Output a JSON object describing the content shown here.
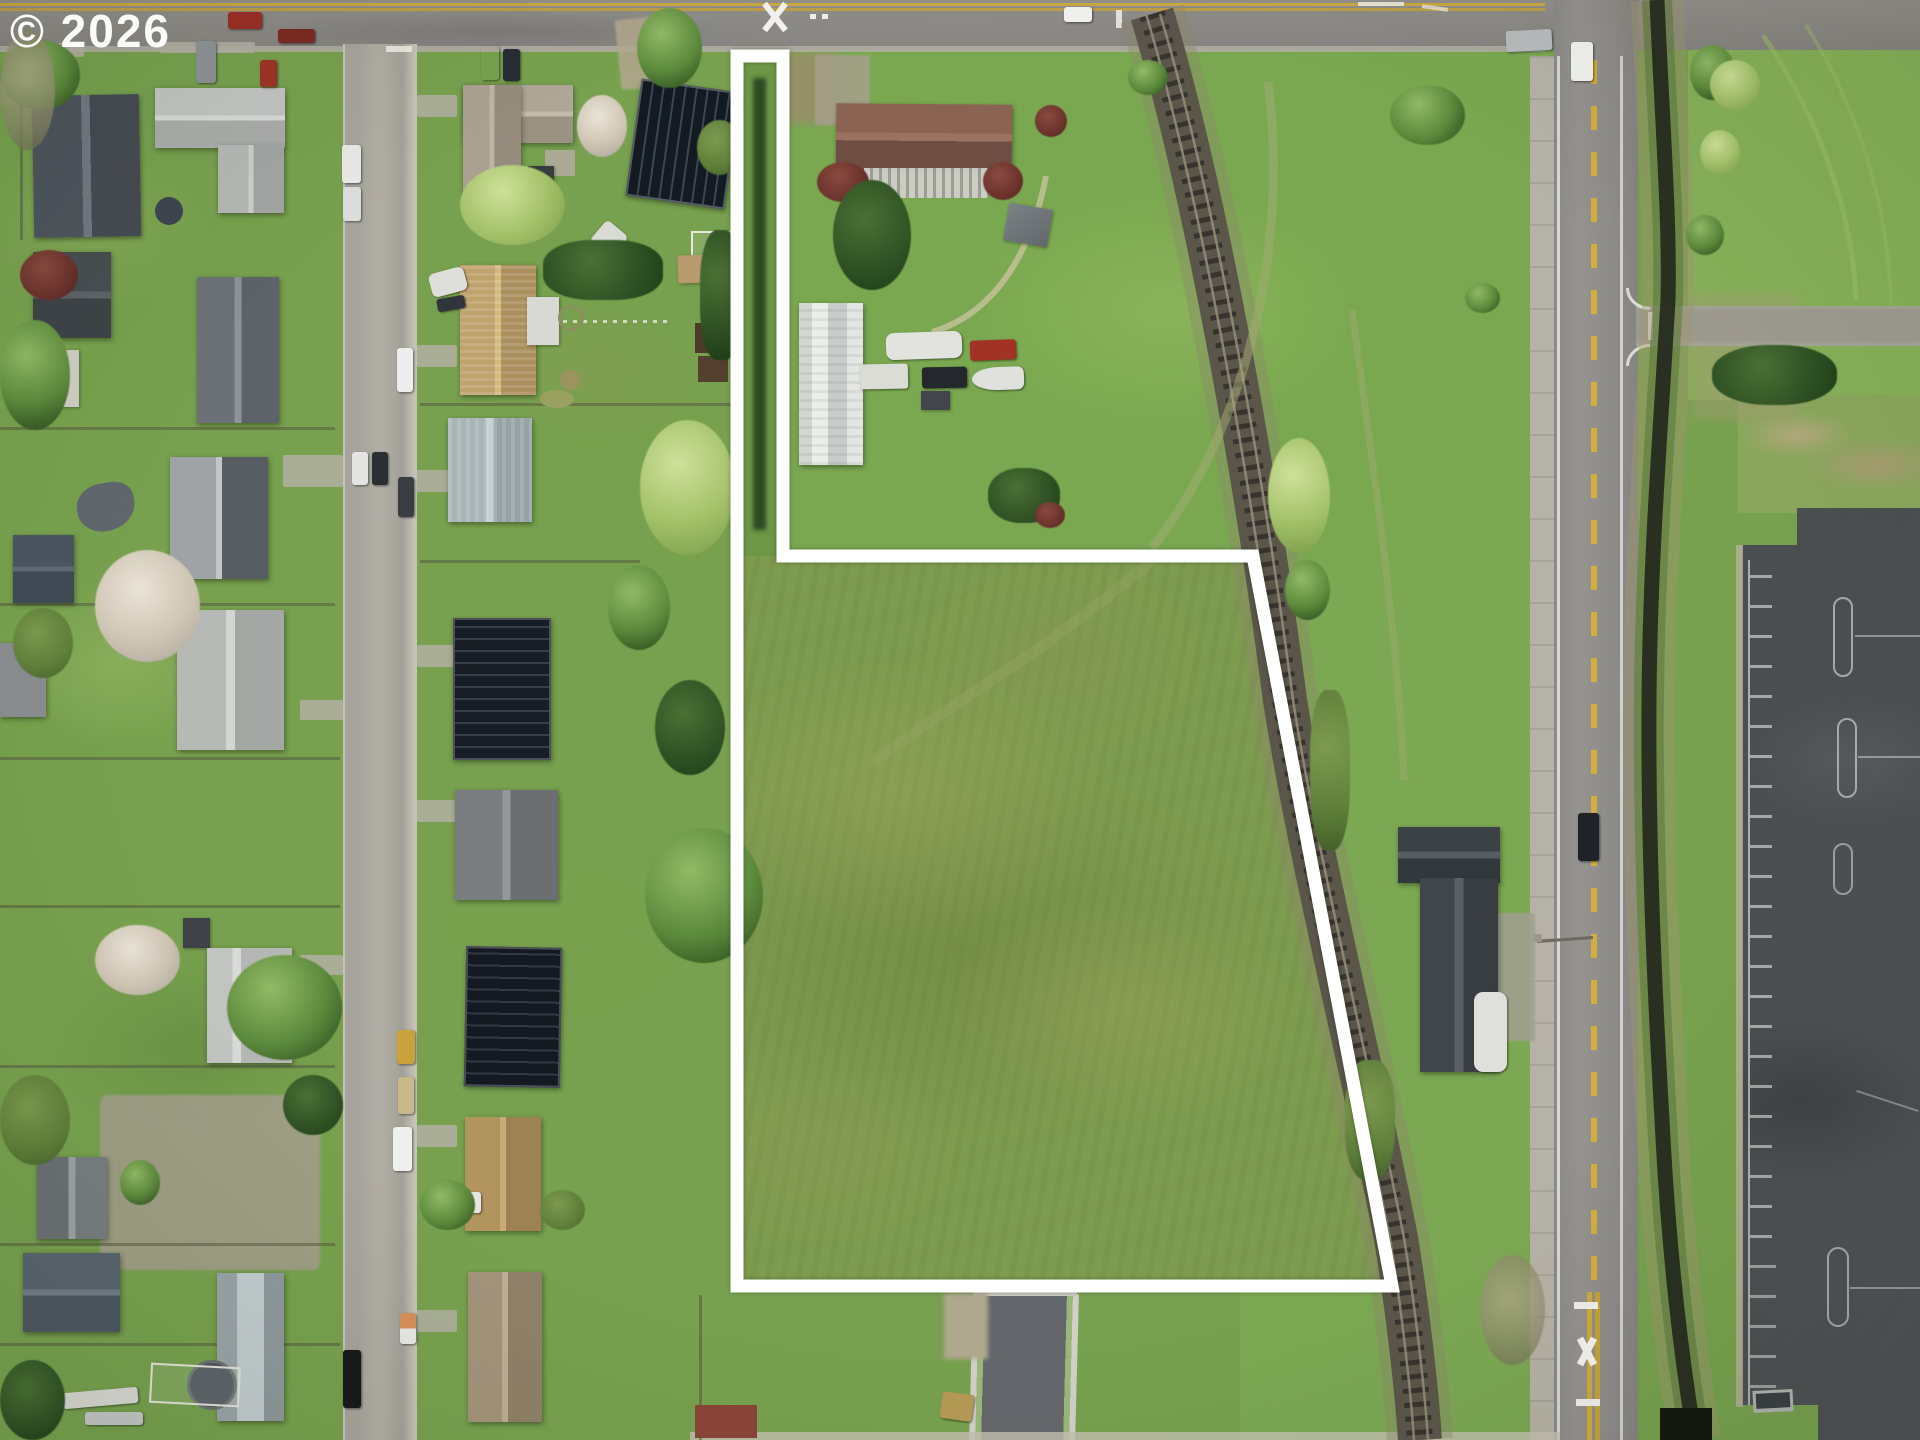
{
  "watermark": {
    "text": "© 2026"
  },
  "property_boundary": {
    "points": "737,56 783,56 783,556 1253,556 1392,1286 737,1286",
    "stroke_color": "#ffffff",
    "stroke_width": 13,
    "shape": "flag-shaped parcel outline with narrow access strip to road"
  },
  "palette": {
    "grass_base": "#77a14e",
    "field_rough": "#7e9c4f",
    "road_gray": "#8f8e8a",
    "street_gray": "#a6a49c",
    "fresh_asphalt": "#63676b",
    "parking_asphalt": "#4d5052",
    "rail_ballast": "#57524a",
    "creek_dark": "#262b20",
    "center_line_yellow": "#d0aa3a",
    "boundary_white": "#ffffff"
  }
}
